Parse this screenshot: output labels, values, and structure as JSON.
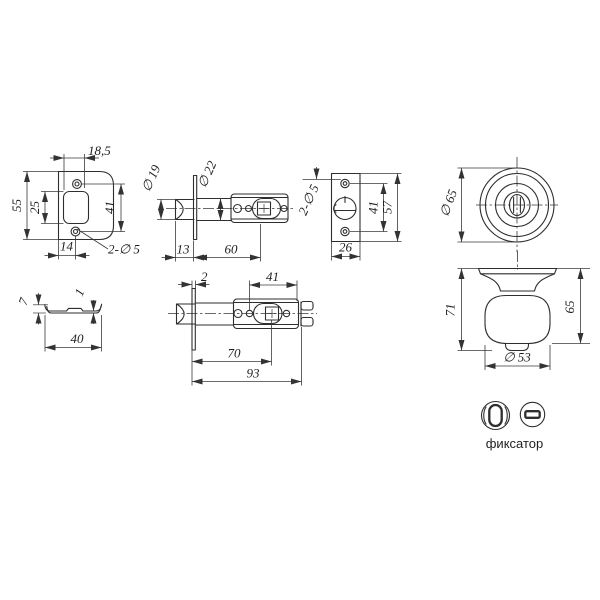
{
  "drawing": {
    "background": "#ffffff",
    "line_color": "#2e2e2e",
    "caption": "фиксатор",
    "views": {
      "faceplate_front": {
        "label": "faceplate front view",
        "dims": {
          "top_width": "18,5",
          "height": "55",
          "cutout_height": "25",
          "hole_span": "41",
          "bottom_offset": "14",
          "holes": "2-∅ 5"
        }
      },
      "latch_backset60": {
        "label": "latch bolt side view, backset 60",
        "dims": {
          "head_diameter": "∅ 19",
          "body_diameter": "∅ 22",
          "head_length": "13",
          "backset": "60"
        }
      },
      "strike_plate": {
        "label": "latch edge view",
        "dims": {
          "holes": "2-∅ 5",
          "hole_span": "41",
          "height": "57",
          "width": "26"
        }
      },
      "knob_front": {
        "label": "knob front view",
        "dims": {
          "diameter": "∅ 65"
        }
      },
      "faceplate_profile": {
        "label": "faceplate profile",
        "dims": {
          "flange_height": "7",
          "thickness": "1",
          "length": "40"
        }
      },
      "latch_backset70": {
        "label": "latch bolt side view, backset 70",
        "dims": {
          "plate_thickness": "2",
          "tail_length": "41",
          "backset": "70",
          "total_length": "93"
        }
      },
      "knob_side": {
        "label": "knob side view",
        "dims": {
          "total_height": "71",
          "knob_height": "65",
          "knob_diameter": "∅ 53"
        }
      }
    }
  }
}
